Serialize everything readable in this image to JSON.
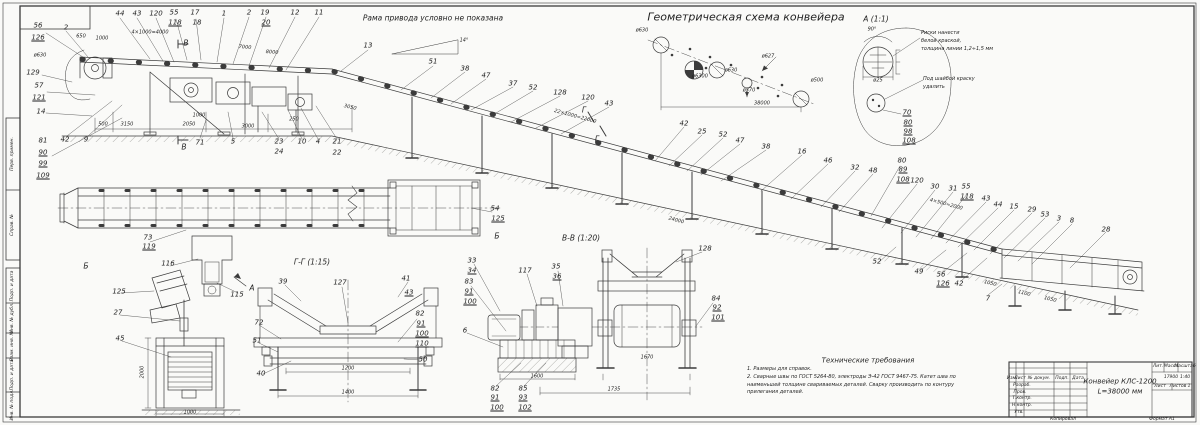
{
  "colors": {
    "line": "#3b3b3b",
    "paper": "#fafaf8",
    "text": "#1f1f1f"
  },
  "title_block": {
    "name_line1": "Конвейер КЛС-1200",
    "name_line2": "L=38000 мм",
    "mass": "17900",
    "scale": "1:40"
  },
  "tb_texts": [
    {
      "x": 1012,
      "y": 379,
      "t": "Изм."
    },
    {
      "x": 1020,
      "y": 379,
      "t": "Лист"
    },
    {
      "x": 1039,
      "y": 379,
      "t": "№ докум."
    },
    {
      "x": 1062,
      "y": 379,
      "t": "Подп."
    },
    {
      "x": 1078,
      "y": 379,
      "t": "Дата"
    },
    {
      "x": 1022,
      "y": 386,
      "t": "Разраб."
    },
    {
      "x": 1020,
      "y": 393,
      "t": "Пров."
    },
    {
      "x": 1022,
      "y": 399,
      "t": "Т.контр."
    },
    {
      "x": 1022,
      "y": 406,
      "t": "Н.контр."
    },
    {
      "x": 1019,
      "y": 413,
      "t": "Утв."
    },
    {
      "x": 1158,
      "y": 367,
      "t": "Лит."
    },
    {
      "x": 1171,
      "y": 367,
      "t": "Масса"
    },
    {
      "x": 1185,
      "y": 367,
      "t": "Масштаб"
    },
    {
      "x": 1160,
      "y": 387,
      "t": "Лист"
    },
    {
      "x": 1180,
      "y": 387,
      "t": "Листов 1"
    },
    {
      "x": 1063,
      "y": 420,
      "t": "Копировал"
    },
    {
      "x": 1162,
      "y": 420,
      "t": "Формат A1"
    }
  ],
  "frame_labels": [
    {
      "x": 13,
      "y": 154,
      "t": "Перв. примен.",
      "r": -90
    },
    {
      "x": 13,
      "y": 225,
      "t": "Справ. №",
      "r": -90
    },
    {
      "x": 13,
      "y": 286,
      "t": "Подп. и дата",
      "r": -90
    },
    {
      "x": 13,
      "y": 318,
      "t": "Инв. № дубл.",
      "r": -90
    },
    {
      "x": 13,
      "y": 346,
      "t": "Взам. инв. №",
      "r": -90
    },
    {
      "x": 13,
      "y": 375,
      "t": "Подп. и дата",
      "r": -90
    },
    {
      "x": 13,
      "y": 405,
      "t": "Инв. № подл.",
      "r": -90
    }
  ],
  "vlabels": [
    {
      "t": "Рама привода условно не показана",
      "x": 433,
      "y": 18
    },
    {
      "t": "Геометрическая схема конвейера",
      "x": 746,
      "y": 17,
      "c": "big"
    },
    {
      "t": "А (1:1)",
      "x": 876,
      "y": 19
    },
    {
      "t": "В-В (1:20)",
      "x": 581,
      "y": 238
    },
    {
      "t": "Г-Г (1:15)",
      "x": 312,
      "y": 262
    },
    {
      "t": "Технические требования",
      "x": 868,
      "y": 361,
      "c": "mid"
    },
    {
      "t": "Б",
      "x": 86,
      "y": 266
    },
    {
      "t": "Б",
      "x": 497,
      "y": 236
    },
    {
      "t": "В",
      "x": 186,
      "y": 43
    },
    {
      "t": "В",
      "x": 184,
      "y": 147
    },
    {
      "t": "Г",
      "x": 584,
      "y": 110
    },
    {
      "t": "Г",
      "x": 597,
      "y": 139
    },
    {
      "t": "А",
      "x": 252,
      "y": 288
    }
  ],
  "notes": [
    {
      "x": 921,
      "y": 30,
      "t": "Риски нанести\nбелой краской,\nтолщина линии 1,2÷1,5 мм"
    },
    {
      "x": 923,
      "y": 76,
      "t": "Под шайбой краску\nудалить"
    },
    {
      "x": 747,
      "y": 366,
      "t": "1. Размеры для справок.\n2. Сварные швы по ГОСТ 5264-80, электроды Э-42 ГОСТ 9467-75. Катет шва по\nнаименьшей толщине свариваемых деталей. Сварку производить по контуру\nприлегания деталей."
    }
  ],
  "callouts": [
    {
      "t": "2",
      "x": 66,
      "y": 28
    },
    {
      "t": "44",
      "x": 120,
      "y": 14
    },
    {
      "t": "43",
      "x": 137,
      "y": 14
    },
    {
      "t": "120",
      "x": 156,
      "y": 14
    },
    {
      "t": "55",
      "x": 174,
      "y": 13
    },
    {
      "t": "118",
      "x": 175,
      "y": 23,
      "u": 1
    },
    {
      "t": "17",
      "x": 195,
      "y": 13
    },
    {
      "t": "18",
      "x": 197,
      "y": 23
    },
    {
      "t": "1",
      "x": 224,
      "y": 14
    },
    {
      "t": "2",
      "x": 249,
      "y": 13
    },
    {
      "t": "19",
      "x": 265,
      "y": 13
    },
    {
      "t": "20",
      "x": 266,
      "y": 23,
      "u": 1
    },
    {
      "t": "12",
      "x": 295,
      "y": 13
    },
    {
      "t": "11",
      "x": 319,
      "y": 13
    },
    {
      "t": "13",
      "x": 368,
      "y": 46
    },
    {
      "t": "56",
      "x": 38,
      "y": 26
    },
    {
      "t": "126",
      "x": 38,
      "y": 38,
      "u": 1
    },
    {
      "t": "129",
      "x": 33,
      "y": 73
    },
    {
      "t": "57",
      "x": 39,
      "y": 86
    },
    {
      "t": "121",
      "x": 39,
      "y": 98,
      "u": 1
    },
    {
      "t": "14",
      "x": 41,
      "y": 112
    },
    {
      "t": "81",
      "x": 43,
      "y": 141
    },
    {
      "t": "90",
      "x": 43,
      "y": 153,
      "u": 1
    },
    {
      "t": "99",
      "x": 43,
      "y": 164,
      "u": 1
    },
    {
      "t": "109",
      "x": 43,
      "y": 176,
      "u": 1
    },
    {
      "t": "42",
      "x": 65,
      "y": 140
    },
    {
      "t": "9",
      "x": 86,
      "y": 140
    },
    {
      "t": "71",
      "x": 200,
      "y": 143
    },
    {
      "t": "5",
      "x": 233,
      "y": 142
    },
    {
      "t": "23",
      "x": 279,
      "y": 142
    },
    {
      "t": "24",
      "x": 279,
      "y": 152
    },
    {
      "t": "10",
      "x": 302,
      "y": 142
    },
    {
      "t": "4",
      "x": 318,
      "y": 142
    },
    {
      "t": "21",
      "x": 337,
      "y": 142
    },
    {
      "t": "22",
      "x": 337,
      "y": 153
    },
    {
      "t": "51",
      "x": 433,
      "y": 62
    },
    {
      "t": "38",
      "x": 465,
      "y": 69
    },
    {
      "t": "47",
      "x": 486,
      "y": 76
    },
    {
      "t": "37",
      "x": 513,
      "y": 84
    },
    {
      "t": "52",
      "x": 533,
      "y": 88
    },
    {
      "t": "128",
      "x": 560,
      "y": 93
    },
    {
      "t": "120",
      "x": 588,
      "y": 98
    },
    {
      "t": "43",
      "x": 609,
      "y": 104
    },
    {
      "t": "42",
      "x": 684,
      "y": 124
    },
    {
      "t": "25",
      "x": 702,
      "y": 132
    },
    {
      "t": "52",
      "x": 723,
      "y": 135
    },
    {
      "t": "47",
      "x": 740,
      "y": 141
    },
    {
      "t": "38",
      "x": 766,
      "y": 147
    },
    {
      "t": "16",
      "x": 802,
      "y": 152
    },
    {
      "t": "46",
      "x": 828,
      "y": 161
    },
    {
      "t": "32",
      "x": 855,
      "y": 168
    },
    {
      "t": "48",
      "x": 873,
      "y": 171
    },
    {
      "t": "70",
      "x": 907,
      "y": 113,
      "u": 1
    },
    {
      "t": "80",
      "x": 908,
      "y": 123,
      "u": 1
    },
    {
      "t": "98",
      "x": 908,
      "y": 132,
      "u": 1
    },
    {
      "t": "108",
      "x": 909,
      "y": 141,
      "u": 1
    },
    {
      "t": "80",
      "x": 902,
      "y": 161
    },
    {
      "t": "89",
      "x": 903,
      "y": 170,
      "u": 1
    },
    {
      "t": "108",
      "x": 903,
      "y": 180,
      "u": 1
    },
    {
      "t": "120",
      "x": 917,
      "y": 181
    },
    {
      "t": "30",
      "x": 935,
      "y": 187
    },
    {
      "t": "31",
      "x": 953,
      "y": 189
    },
    {
      "t": "55",
      "x": 966,
      "y": 187
    },
    {
      "t": "118",
      "x": 967,
      "y": 197,
      "u": 1
    },
    {
      "t": "43",
      "x": 986,
      "y": 199
    },
    {
      "t": "44",
      "x": 998,
      "y": 205
    },
    {
      "t": "15",
      "x": 1014,
      "y": 207
    },
    {
      "t": "29",
      "x": 1032,
      "y": 210
    },
    {
      "t": "53",
      "x": 1045,
      "y": 215
    },
    {
      "t": "3",
      "x": 1059,
      "y": 219
    },
    {
      "t": "8",
      "x": 1072,
      "y": 221
    },
    {
      "t": "28",
      "x": 1106,
      "y": 230
    },
    {
      "t": "52",
      "x": 877,
      "y": 262
    },
    {
      "t": "49",
      "x": 919,
      "y": 272
    },
    {
      "t": "56",
      "x": 941,
      "y": 275
    },
    {
      "t": "126",
      "x": 943,
      "y": 284,
      "u": 1
    },
    {
      "t": "42",
      "x": 959,
      "y": 284
    },
    {
      "t": "7",
      "x": 988,
      "y": 299
    },
    {
      "t": "73",
      "x": 148,
      "y": 238
    },
    {
      "t": "119",
      "x": 149,
      "y": 247,
      "u": 1
    },
    {
      "t": "116",
      "x": 168,
      "y": 264
    },
    {
      "t": "115",
      "x": 237,
      "y": 295
    },
    {
      "t": "54",
      "x": 495,
      "y": 209
    },
    {
      "t": "125",
      "x": 498,
      "y": 219,
      "u": 1
    },
    {
      "t": "125",
      "x": 119,
      "y": 292
    },
    {
      "t": "27",
      "x": 118,
      "y": 313
    },
    {
      "t": "45",
      "x": 120,
      "y": 339
    },
    {
      "t": "39",
      "x": 283,
      "y": 282
    },
    {
      "t": "127",
      "x": 340,
      "y": 283
    },
    {
      "t": "41",
      "x": 406,
      "y": 279
    },
    {
      "t": "43",
      "x": 409,
      "y": 293,
      "u": 1
    },
    {
      "t": "72",
      "x": 259,
      "y": 323
    },
    {
      "t": "51",
      "x": 257,
      "y": 341
    },
    {
      "t": "40",
      "x": 261,
      "y": 374
    },
    {
      "t": "82",
      "x": 420,
      "y": 314
    },
    {
      "t": "91",
      "x": 421,
      "y": 324,
      "u": 1
    },
    {
      "t": "100",
      "x": 422,
      "y": 334,
      "u": 1
    },
    {
      "t": "110",
      "x": 422,
      "y": 344,
      "u": 1
    },
    {
      "t": "50",
      "x": 423,
      "y": 360
    },
    {
      "t": "33",
      "x": 472,
      "y": 261
    },
    {
      "t": "34",
      "x": 472,
      "y": 271,
      "u": 1
    },
    {
      "t": "83",
      "x": 469,
      "y": 282
    },
    {
      "t": "91",
      "x": 469,
      "y": 292,
      "u": 1
    },
    {
      "t": "100",
      "x": 470,
      "y": 302,
      "u": 1
    },
    {
      "t": "117",
      "x": 525,
      "y": 271
    },
    {
      "t": "35",
      "x": 556,
      "y": 267
    },
    {
      "t": "36",
      "x": 557,
      "y": 277,
      "u": 1
    },
    {
      "t": "128",
      "x": 705,
      "y": 249
    },
    {
      "t": "84",
      "x": 716,
      "y": 299
    },
    {
      "t": "92",
      "x": 717,
      "y": 308,
      "u": 1
    },
    {
      "t": "101",
      "x": 718,
      "y": 318,
      "u": 1
    },
    {
      "t": "6",
      "x": 465,
      "y": 331
    },
    {
      "t": "82",
      "x": 495,
      "y": 389
    },
    {
      "t": "91",
      "x": 495,
      "y": 398,
      "u": 1
    },
    {
      "t": "100",
      "x": 497,
      "y": 408,
      "u": 1
    },
    {
      "t": "85",
      "x": 523,
      "y": 389
    },
    {
      "t": "93",
      "x": 523,
      "y": 398,
      "u": 1
    },
    {
      "t": "102",
      "x": 525,
      "y": 408,
      "u": 1
    }
  ],
  "dims": [
    {
      "t": "500",
      "x": 103,
      "y": 125
    },
    {
      "t": "3150",
      "x": 127,
      "y": 125
    },
    {
      "t": "2050",
      "x": 189,
      "y": 125
    },
    {
      "t": "3000",
      "x": 248,
      "y": 127
    },
    {
      "t": "1000",
      "x": 199,
      "y": 116
    },
    {
      "t": "250",
      "x": 294,
      "y": 120
    },
    {
      "t": "3050",
      "x": 350,
      "y": 108,
      "r": 13
    },
    {
      "t": "650",
      "x": 81,
      "y": 37
    },
    {
      "t": "1000",
      "x": 102,
      "y": 39
    },
    {
      "t": "4×1000=4000",
      "x": 150,
      "y": 33
    },
    {
      "t": "7000",
      "x": 245,
      "y": 48,
      "r": 4
    },
    {
      "t": "8000",
      "x": 272,
      "y": 53,
      "r": 5
    },
    {
      "t": "22×1000=22000",
      "x": 575,
      "y": 117,
      "r": 15
    },
    {
      "t": "24000",
      "x": 676,
      "y": 221,
      "r": 15
    },
    {
      "t": "4×500=2000",
      "x": 946,
      "y": 205,
      "r": 15
    },
    {
      "t": "1050",
      "x": 990,
      "y": 284,
      "r": 14
    },
    {
      "t": "1100",
      "x": 1024,
      "y": 294,
      "r": 14
    },
    {
      "t": "1050",
      "x": 1050,
      "y": 300,
      "r": 14
    },
    {
      "t": "38000",
      "x": 762,
      "y": 104
    },
    {
      "t": "ø630",
      "x": 642,
      "y": 31
    },
    {
      "t": "ø6300",
      "x": 700,
      "y": 77
    },
    {
      "t": "ø630",
      "x": 731,
      "y": 71
    },
    {
      "t": "ø370",
      "x": 749,
      "y": 91
    },
    {
      "t": "ø627",
      "x": 768,
      "y": 57
    },
    {
      "t": "ø500",
      "x": 817,
      "y": 81
    },
    {
      "t": "ø25",
      "x": 878,
      "y": 81
    },
    {
      "t": "90°",
      "x": 872,
      "y": 30
    },
    {
      "t": "14°",
      "x": 464,
      "y": 41
    },
    {
      "t": "ø630",
      "x": 40,
      "y": 56
    },
    {
      "t": "1200",
      "x": 348,
      "y": 369
    },
    {
      "t": "1400",
      "x": 348,
      "y": 393
    },
    {
      "t": "1600",
      "x": 537,
      "y": 377
    },
    {
      "t": "1735",
      "x": 614,
      "y": 390
    },
    {
      "t": "1670",
      "x": 647,
      "y": 358
    },
    {
      "t": "2000",
      "x": 143,
      "y": 372,
      "r": -90
    },
    {
      "t": "1000",
      "x": 190,
      "y": 413
    }
  ]
}
